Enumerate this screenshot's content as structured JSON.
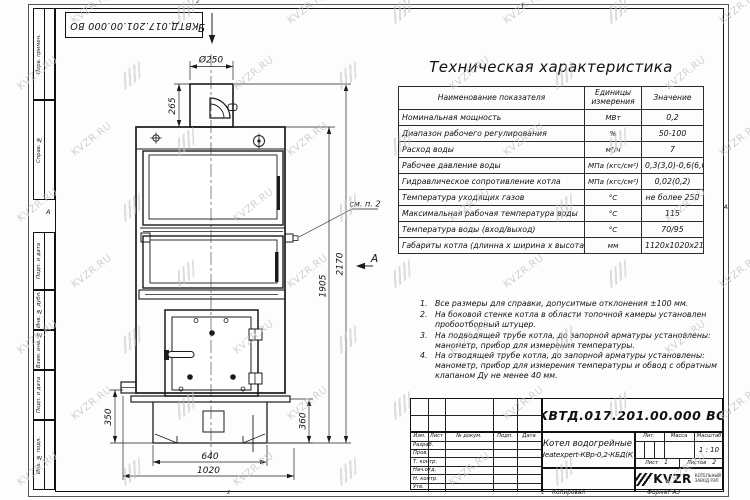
{
  "stamp_top": "КВТД.017.201.00.000 ВО",
  "frame": {
    "margin_labels": [
      "Перв. примен.",
      "Справ. №",
      "Подп. и дата",
      "Инв. № дубл.",
      "Взам. инв. №",
      "Подп. и дата",
      "Инв. № подл."
    ],
    "zone_marker_left": "А",
    "zone_marker_right": "А",
    "zone_numbers": {
      "top": "2",
      "bottom_left": "2",
      "bottom_right": "1"
    }
  },
  "tech_table": {
    "title": "Техническая характеристика",
    "columns": [
      "Наименование показателя",
      "Единицы измерения",
      "Значение"
    ],
    "rows": [
      [
        "Номинальная мощность",
        "МВт",
        "0,2"
      ],
      [
        "Диапазон рабочего регулирования",
        "%",
        "50-100"
      ],
      [
        "Расход воды",
        "м³/ч",
        "7"
      ],
      [
        "Рабочее давление воды",
        "МПа (кгс/см²)",
        "0,3(3,0)-0,6(6,0)"
      ],
      [
        "Гидравлическое сопротивление котла",
        "МПа (кгс/см²)",
        "0,02(0,2)"
      ],
      [
        "Температура уходящих газов",
        "°С",
        "не более 250"
      ],
      [
        "Максимальная рабочая температура воды",
        "°С",
        "115"
      ],
      [
        "Температура воды (вход/выход)",
        "°С",
        "70/95"
      ],
      [
        "Габариты котла (длинна х ширина х высота)",
        "мм",
        "1120х1020х2170"
      ]
    ]
  },
  "notes": [
    "Все размеры для справки, допуситмые отклонения ±100 мм.",
    "На боковой стенке котла в области топочной камеры установлен пробоотборный штуцер.",
    "На подводящей трубе котла, до запорной арматуры установлены: манометр, прибор для измерения температуры.",
    "На отводящей трубе котла, до запорной арматуры установлены: манометр, прибор для измерения температуры и обвод с обратным клапаном Ду не менее 40 мм."
  ],
  "drawing": {
    "dims": {
      "diameter": "Ø250",
      "chimney": "265",
      "total_height": "2170",
      "body_height": "1905",
      "base_height": "350",
      "right_height": "360",
      "base_width": "640",
      "overall_width": "1020"
    },
    "callout": "см. п. 2",
    "views": {
      "a": "А",
      "b": "Б"
    }
  },
  "title_block": {
    "doc_number": "КВТД.017.201.00.000 ВО",
    "product_name_line1": "Котел водогрейные",
    "product_name_line2": "Heatexpert-КВр-0,2-КБД(К)",
    "header_cols": [
      "Изм.",
      "Лист",
      "№ докум.",
      "Подп.",
      "Дата"
    ],
    "sign_rows": [
      "Разраб.",
      "Пров.",
      "Т. контр.",
      "Нач.отд.",
      "Н. контр.",
      "Утв."
    ],
    "lit_label": "Лит.",
    "mass_label": "Масса",
    "scale_label": "Масштаб",
    "scale_value": "1 : 10",
    "sheet_label": "Лист",
    "sheet_value": "1",
    "sheets_label": "Листов",
    "sheets_value": "2",
    "logo_text": "KVZR",
    "logo_sub1": "КОТЕЛЬНЫЙ",
    "logo_sub2": "ЗАВОД РЭП",
    "footer_copy": "Копировал",
    "footer_format": "Формат А3"
  },
  "watermark": {
    "text": "KVZR.RU"
  }
}
